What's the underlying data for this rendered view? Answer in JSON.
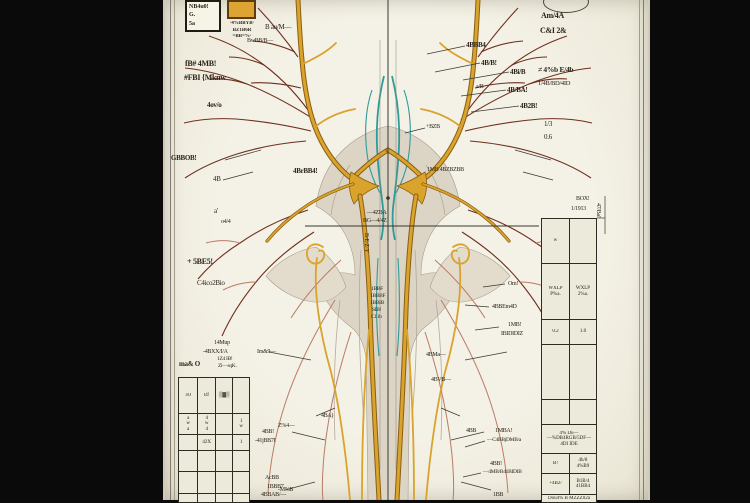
{
  "colors": {
    "paper": "#f2efe3",
    "gold": "#d9a32c",
    "gold_dark": "#8a5f14",
    "teal": "#2f9b98",
    "branch": "#6e2f1d",
    "branch_light": "#b97b63",
    "bone": "#dcd5c6",
    "table_bg": "#eceadb",
    "frame": "#0a0a0a"
  },
  "legend": {
    "box_lines": [
      "NB4u0!",
      "G.",
      "5a"
    ],
    "swatch_color": "#dda433",
    "caption_lines": [
      "·4%BBYB·",
      "BZ1B6R",
      "=BB=%·"
    ]
  },
  "labels": [
    {
      "t": "B au/M—",
      "x": 100,
      "y": 24,
      "s": 7
    },
    {
      "t": "BwBB/B—",
      "x": 82,
      "y": 38,
      "s": 6
    },
    {
      "t": "fB# 4MB!",
      "x": 20,
      "y": 60,
      "s": 8,
      "b": 1
    },
    {
      "t": "#FBI {Mknw",
      "x": 19,
      "y": 74,
      "s": 8,
      "b": 1
    },
    {
      "t": "4ov/o",
      "x": 42,
      "y": 102,
      "s": 7,
      "b": 1
    },
    {
      "t": "GBBOB!",
      "x": 6,
      "y": 155,
      "s": 7,
      "b": 1
    },
    {
      "t": "4B",
      "x": 48,
      "y": 176,
      "s": 7
    },
    {
      "t": "a'",
      "x": 49,
      "y": 208,
      "s": 7
    },
    {
      "t": "o4/4",
      "x": 56,
      "y": 219,
      "s": 6
    },
    {
      "t": "+ 5BE5!",
      "x": 22,
      "y": 258,
      "s": 8,
      "b": 1
    },
    {
      "t": "C4ico2Bio",
      "x": 32,
      "y": 280,
      "s": 7
    },
    {
      "t": "14Mup",
      "x": 49,
      "y": 340,
      "s": 6
    },
    {
      "t": "-4BXX/I/A",
      "x": 38,
      "y": 349,
      "s": 6
    },
    {
      "t": "1Z4 IB!",
      "x": 52,
      "y": 357,
      "s": 5.5
    },
    {
      "t": "Zi—sqK.",
      "x": 53,
      "y": 364,
      "s": 5.5
    },
    {
      "t": "ma& O",
      "x": 14,
      "y": 361,
      "s": 7,
      "b": 1
    },
    {
      "t": "Im&9—",
      "x": 92,
      "y": 349,
      "s": 6
    },
    {
      "t": "4BB!",
      "x": 97,
      "y": 429,
      "s": 6
    },
    {
      "t": "-41jBB7I",
      "x": 90,
      "y": 438,
      "s": 6
    },
    {
      "t": "AcBB",
      "x": 100,
      "y": 475,
      "s": 6
    },
    {
      "t": "1BBB7",
      "x": 102,
      "y": 484,
      "s": 6
    },
    {
      "t": "4BBAB/—",
      "x": 96,
      "y": 492,
      "s": 6
    },
    {
      "t": "4BA)",
      "x": 156,
      "y": 413,
      "s": 6
    },
    {
      "t": "Z%4—",
      "x": 113,
      "y": 423,
      "s": 6
    },
    {
      "t": "-M%B",
      "x": 113,
      "y": 487,
      "s": 6
    },
    {
      "t": "4BrBB4!",
      "x": 128,
      "y": 168,
      "s": 7,
      "b": 1
    },
    {
      "t": "1MB 4BZBZBB",
      "x": 262,
      "y": 167,
      "s": 6
    },
    {
      "t": "—4ZBA",
      "x": 202,
      "y": 210,
      "s": 6
    },
    {
      "t": "BG—4/4Z",
      "x": 198,
      "y": 218,
      "s": 6
    },
    {
      "t": "B·E·Z·Y",
      "x": 204,
      "y": 233,
      "s": 6,
      "r": 90
    },
    {
      "t": "1BBF",
      "x": 206,
      "y": 287,
      "s": 5.5
    },
    {
      "t": "1BBBF",
      "x": 205,
      "y": 294,
      "s": 5.5
    },
    {
      "t": "1BBIB",
      "x": 205,
      "y": 301,
      "s": 5.5
    },
    {
      "t": "SIB!",
      "x": 207,
      "y": 308,
      "s": 5.5
    },
    {
      "t": "C1 ib",
      "x": 206,
      "y": 315,
      "s": 5.5
    },
    {
      "t": "4BBB4",
      "x": 301,
      "y": 42,
      "s": 7,
      "b": 1
    },
    {
      "t": "4B/B!",
      "x": 316,
      "y": 60,
      "s": 7,
      "b": 1
    },
    {
      "t": "4Bi/B",
      "x": 345,
      "y": 69,
      "s": 7,
      "b": 1
    },
    {
      "t": "4B/BA!",
      "x": 342,
      "y": 87,
      "s": 7,
      "b": 1
    },
    {
      "t": "4B2B!",
      "x": 355,
      "y": 103,
      "s": 7,
      "b": 1
    },
    {
      "t": "a/B",
      "x": 311,
      "y": 84,
      "s": 6
    },
    {
      "t": "+BZB",
      "x": 261,
      "y": 124,
      "s": 6
    },
    {
      "t": "Am/4A",
      "x": 376,
      "y": 12,
      "s": 8,
      "b": 1
    },
    {
      "t": "C&I 2&",
      "x": 375,
      "y": 27,
      "s": 8,
      "b": 1
    },
    {
      "t": "≠ 4%b E/4b",
      "x": 373,
      "y": 66,
      "s": 7.5,
      "b": 1
    },
    {
      "t": "1/4B/BD/4ID",
      "x": 373,
      "y": 81,
      "s": 6.5
    },
    {
      "t": "1/3",
      "x": 379,
      "y": 121,
      "s": 7
    },
    {
      "t": "0.6",
      "x": 379,
      "y": 134,
      "s": 7
    },
    {
      "t": "Om!",
      "x": 343,
      "y": 281,
      "s": 6
    },
    {
      "t": "4BBEm4D",
      "x": 327,
      "y": 304,
      "s": 6
    },
    {
      "t": "1MB!",
      "x": 343,
      "y": 322,
      "s": 6
    },
    {
      "t": "IBIDIDIZ",
      "x": 336,
      "y": 331,
      "s": 6
    },
    {
      "t": "4BMa—",
      "x": 261,
      "y": 352,
      "s": 6
    },
    {
      "t": "4BVB—",
      "x": 266,
      "y": 377,
      "s": 6
    },
    {
      "t": "4BB",
      "x": 301,
      "y": 428,
      "s": 6
    },
    {
      "t": "1MBA!",
      "x": 330,
      "y": 428,
      "s": 6
    },
    {
      "t": "—C4BBjDMB/a",
      "x": 322,
      "y": 438,
      "s": 5.5
    },
    {
      "t": "4BB!",
      "x": 325,
      "y": 461,
      "s": 6
    },
    {
      "t": "—4MB/B41BIDIB",
      "x": 318,
      "y": 470,
      "s": 5.5
    },
    {
      "t": "1BB",
      "x": 328,
      "y": 492,
      "s": 6
    },
    {
      "t": "BOX!",
      "x": 411,
      "y": 196,
      "s": 6
    },
    {
      "t": "1/1913",
      "x": 406,
      "y": 206,
      "s": 6
    },
    {
      "t": "47/Ba!",
      "x": 436,
      "y": 203,
      "s": 6,
      "r": 90
    },
    {
      "t": "t,P ——— 4%",
      "x": 381,
      "y": 301,
      "s": 5
    },
    {
      "t": "02/4!",
      "x": 393,
      "y": 334,
      "s": 5.5
    }
  ],
  "tables": {
    "left": {
      "x": 13,
      "y": 377,
      "col_widths": [
        19,
        18,
        18,
        17
      ],
      "row_heights": [
        35,
        21,
        16,
        21,
        22,
        9
      ],
      "rows": [
        [
          "3O",
          "t4!",
          "▒▓▒",
          ""
        ],
        [
          "a\nw\na",
          "4\nw\n4",
          "",
          "1\nw"
        ],
        [
          "",
          "42X",
          "",
          "1"
        ],
        [
          "",
          "",
          "",
          ""
        ],
        [
          "",
          "",
          "",
          ""
        ],
        [
          "",
          "",
          "",
          ""
        ]
      ]
    },
    "right": {
      "x": 376,
      "y": 218,
      "col_widths": [
        28,
        28
      ],
      "row_heights": [
        44,
        56,
        25,
        55,
        25,
        29,
        20,
        21,
        8
      ],
      "rows": [
        [
          "w",
          ""
        ],
        [
          "WXLP\nP%a.",
          "WXLP\n2%a."
        ],
        [
          "0.2",
          "1.0"
        ],
        [
          "",
          ""
        ],
        [
          "",
          ""
        ],
        [
          "4% Du—\n—%DB4RGB/5DF—\n4DI IDE"
        ],
        [
          "B!",
          "4h/8\n4%B9"
        ],
        [
          "+4B2/",
          "B1B/4\n41BB4"
        ],
        [
          "Dou4% B MZZZ02a"
        ]
      ]
    }
  }
}
